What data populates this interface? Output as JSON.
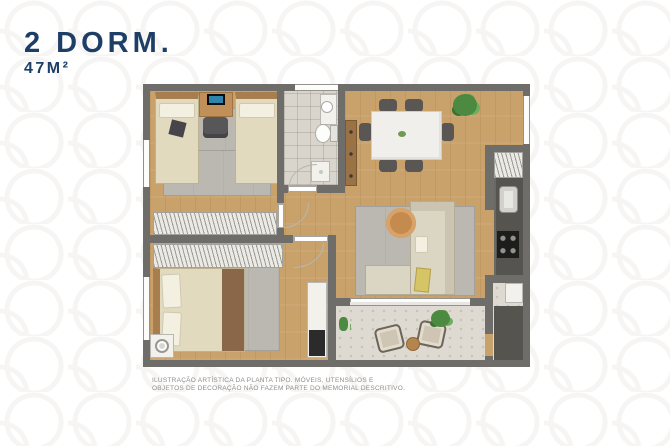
{
  "header": {
    "title": "2 DORM.",
    "area": "47M²"
  },
  "footer": {
    "line1": "ILUSTRAÇÃO ARTÍSTICA DA PLANTA TIPO. MÓVEIS, UTENSÍLIOS E",
    "line2": "OBJETOS DE DECORAÇÃO NÃO FAZEM PARTE DO MEMORIAL DESCRITIVO."
  },
  "colors": {
    "accent": "#1d3e66",
    "muted": "#8f8d8a",
    "pattern": "#f0eeec",
    "wall": "#6f6d69",
    "wood": "#c9a26b",
    "tile": "#d9d5cc",
    "rug": "#bab8b1",
    "counter": "#55544e"
  }
}
